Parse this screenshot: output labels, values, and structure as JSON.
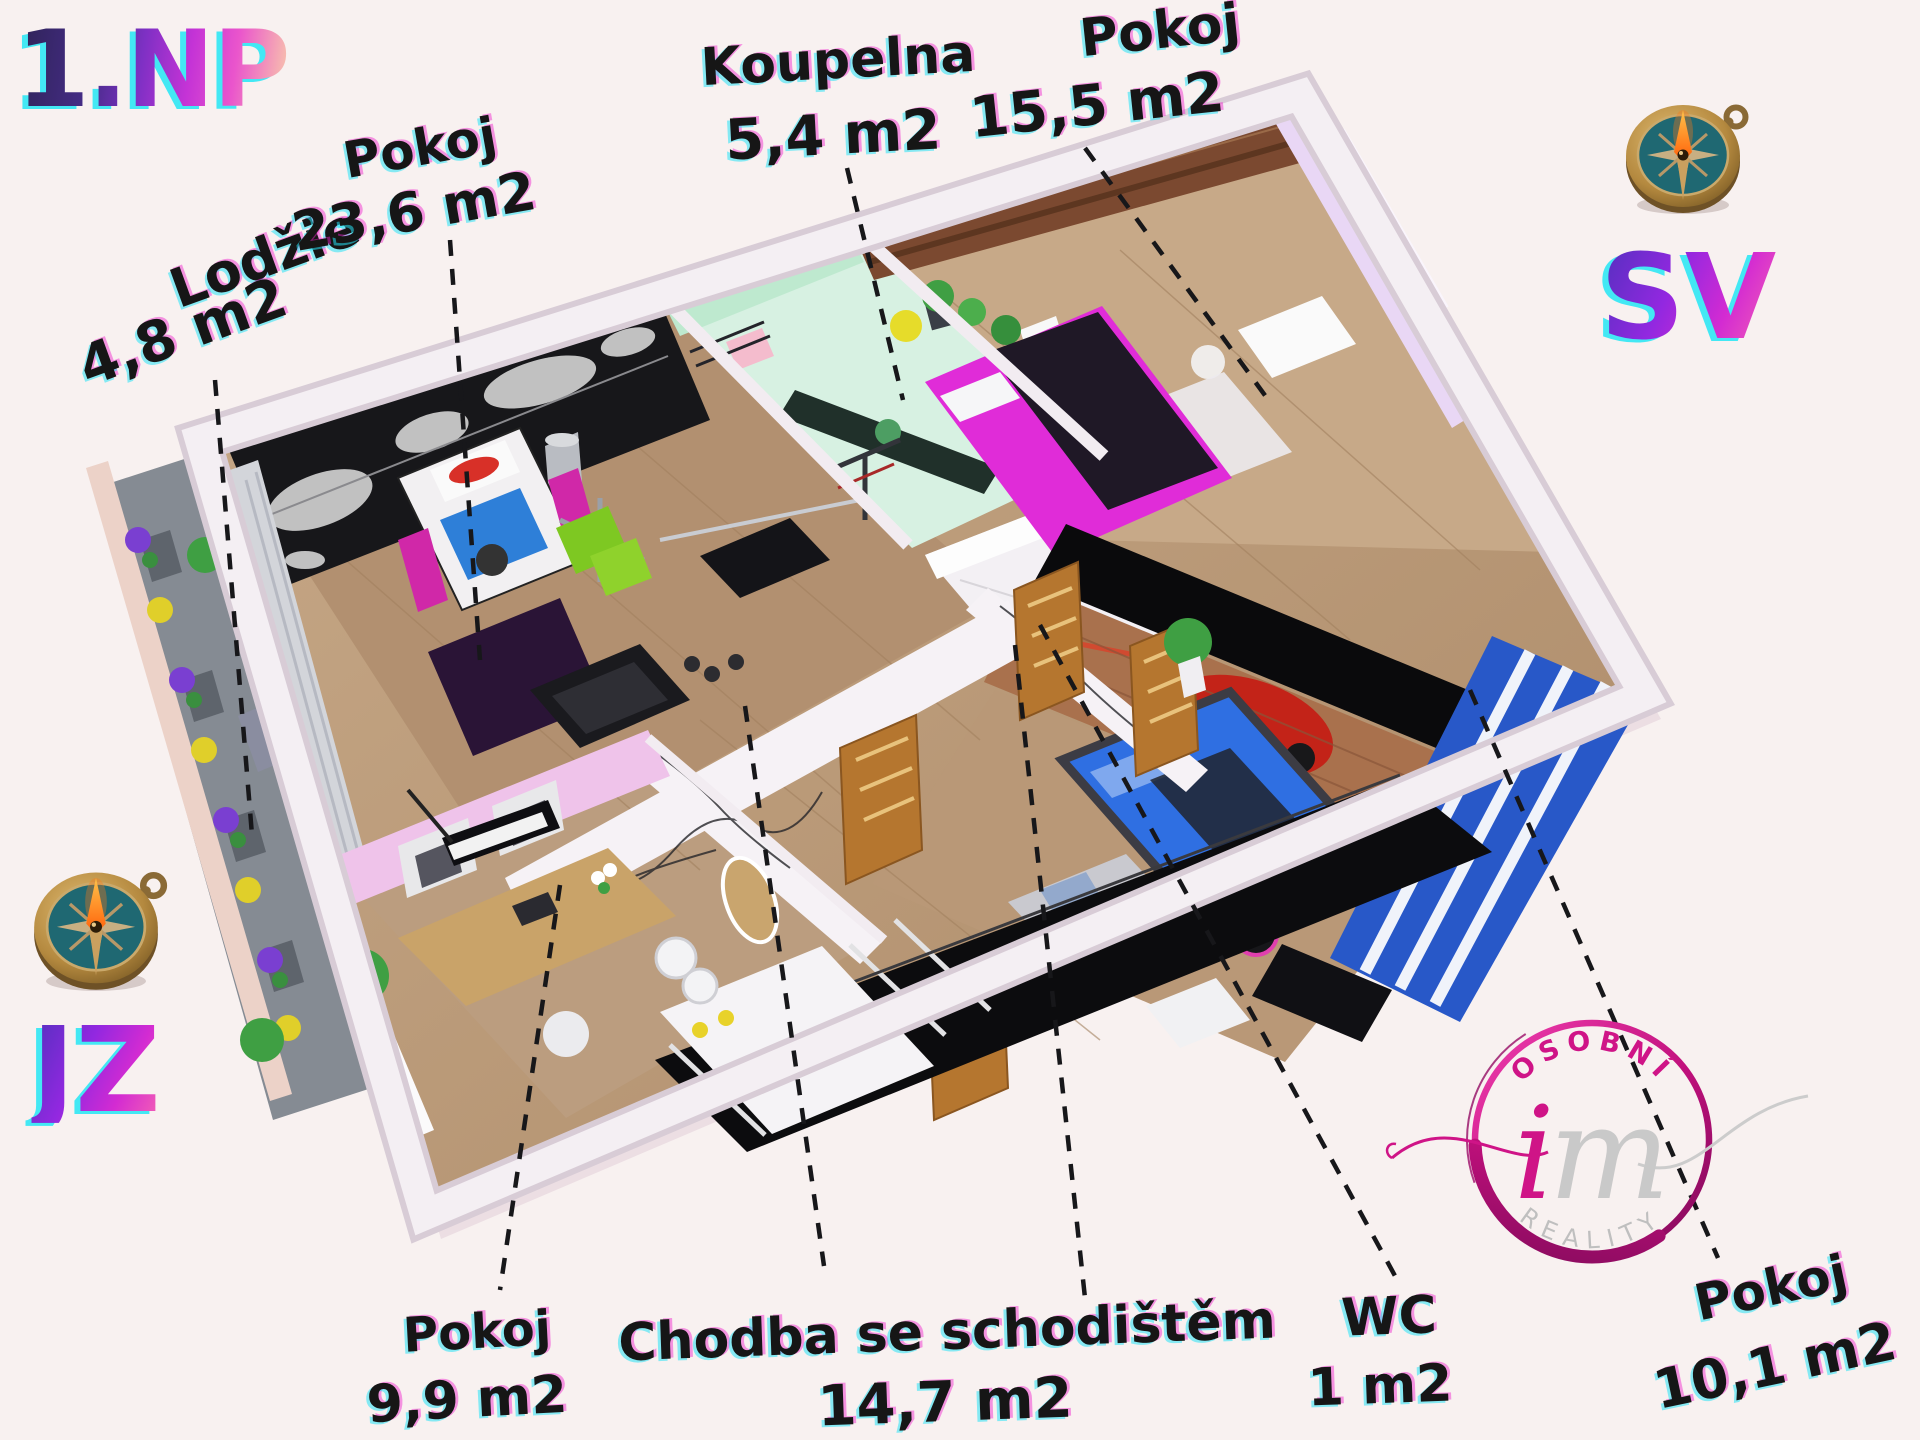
{
  "floor_title": "1.NP",
  "orientation": {
    "top_right": "SV",
    "bottom_left": "JZ"
  },
  "rooms": [
    {
      "name": "Lodžie",
      "area": "4,8 m2"
    },
    {
      "name": "Pokoj",
      "area": "23,6 m2"
    },
    {
      "name": "Koupelna",
      "area": "5,4 m2"
    },
    {
      "name": "Pokoj",
      "area": "15,5 m2"
    },
    {
      "name": "Pokoj",
      "area": "9,9 m2"
    },
    {
      "name": "Chodba se schodištěm",
      "area": "14,7 m2"
    },
    {
      "name": "WC",
      "area": "1 m2"
    },
    {
      "name": "Pokoj",
      "area": "10,1 m2"
    }
  ],
  "logo": {
    "arc_top": "OSOBNÍ",
    "monogram_i": "i",
    "monogram_m": "m",
    "arc_bottom": "REALITY"
  },
  "colors": {
    "accent_magenta": "#cf1487",
    "gradient_purple": "#5a2fc2",
    "gradient_pink": "#f05ab8",
    "glitch_cyan": "#23e6f2",
    "label_ink": "#161616",
    "background": "#f8f1f0"
  }
}
